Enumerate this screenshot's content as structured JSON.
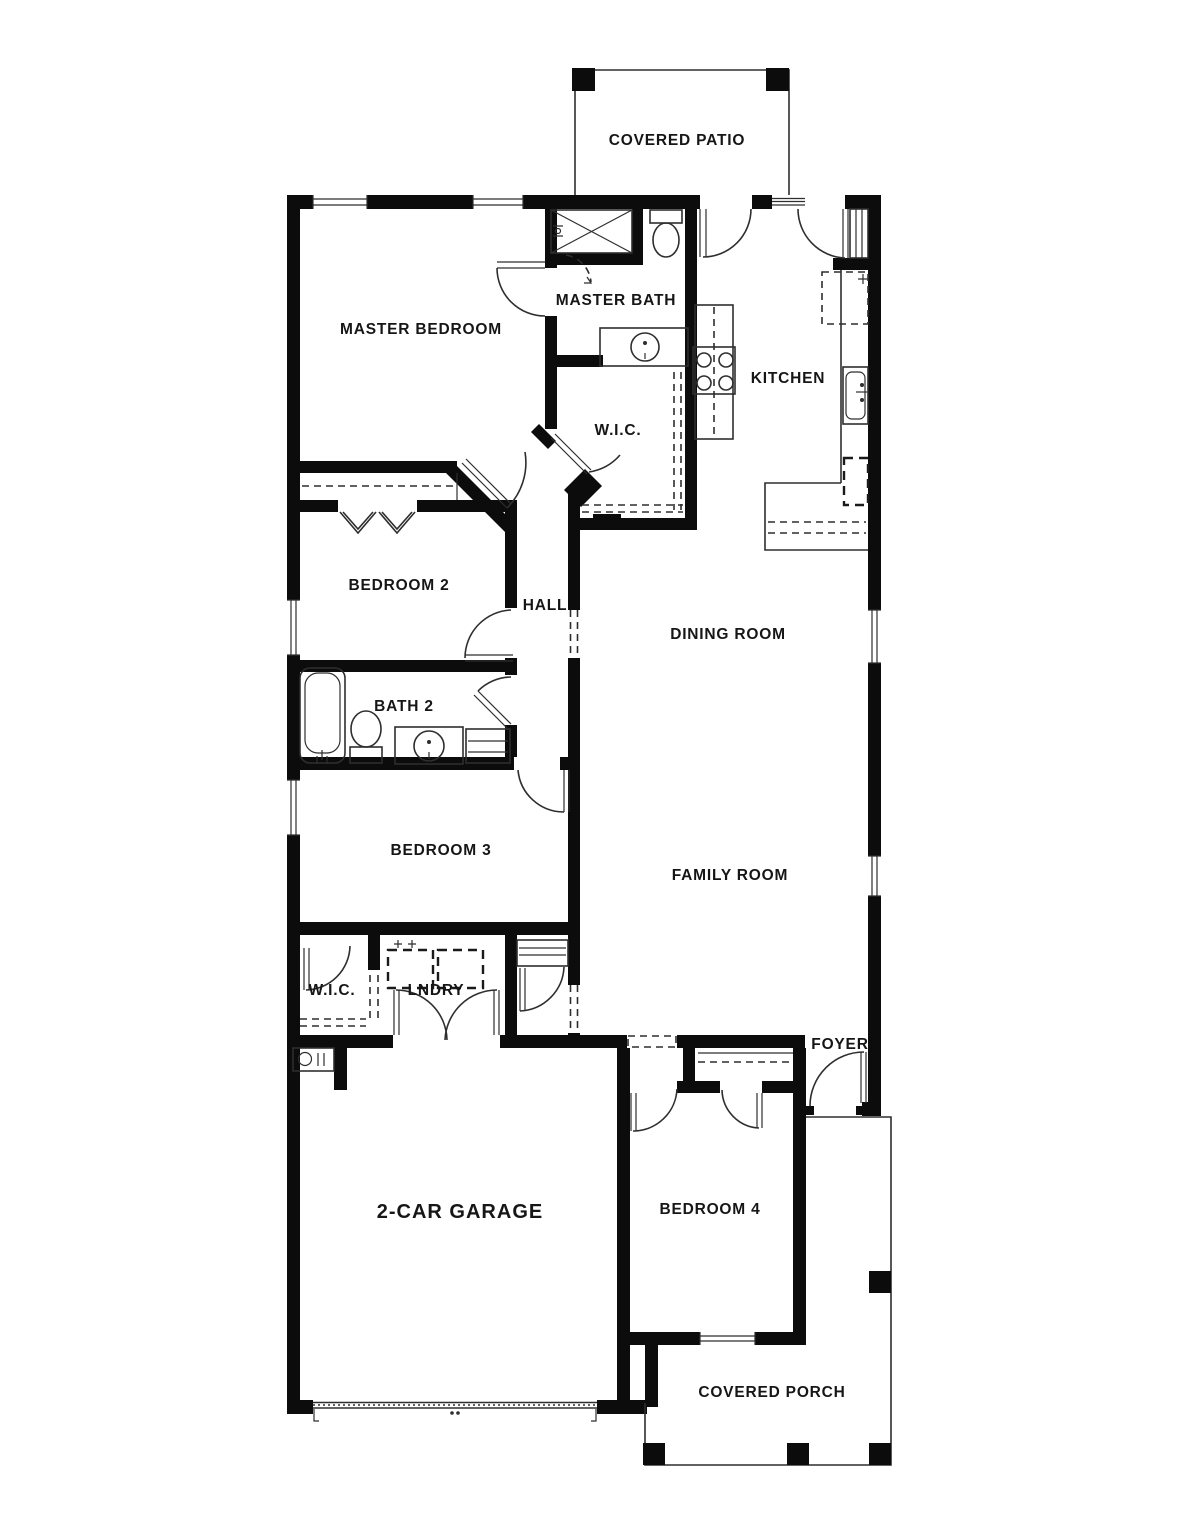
{
  "colors": {
    "wall": "#0c0c0c",
    "line": "#2e2e2e",
    "bg": "#ffffff"
  },
  "rooms": {
    "covered_patio": {
      "label": "COVERED PATIO"
    },
    "master_bedroom": {
      "label": "MASTER BEDROOM"
    },
    "master_bath": {
      "label": "MASTER BATH"
    },
    "kitchen": {
      "label": "KITCHEN"
    },
    "master_wic": {
      "label": "W.I.C."
    },
    "bedroom2": {
      "label": "BEDROOM 2"
    },
    "hall": {
      "label": "HALL"
    },
    "dining_room": {
      "label": "DINING ROOM"
    },
    "bath2": {
      "label": "BATH 2"
    },
    "bedroom3": {
      "label": "BEDROOM 3"
    },
    "family_room": {
      "label": "FAMILY ROOM"
    },
    "wic2": {
      "label": "W.I.C."
    },
    "laundry": {
      "label": "LNDRY"
    },
    "foyer": {
      "label": "FOYER"
    },
    "garage": {
      "label": "2-CAR GARAGE"
    },
    "bedroom4": {
      "label": "BEDROOM 4"
    },
    "covered_porch": {
      "label": "COVERED PORCH"
    }
  }
}
